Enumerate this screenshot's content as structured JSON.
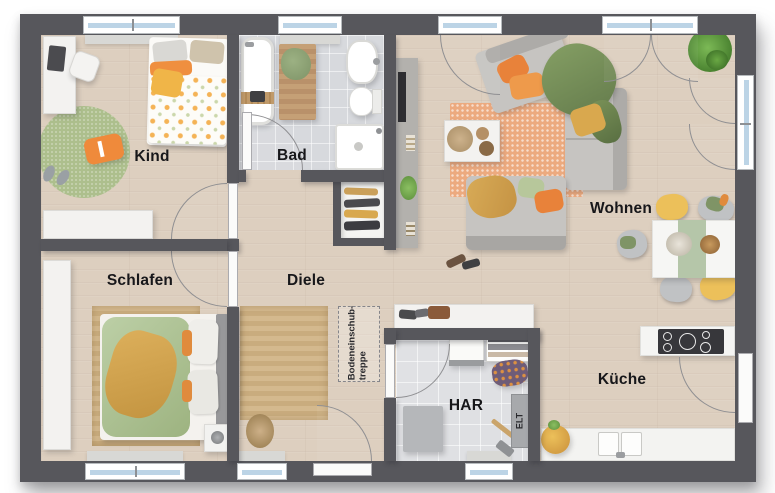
{
  "rooms": [
    {
      "id": "kind",
      "label": "Kind",
      "furniture": [
        "desk",
        "desk-chair",
        "single-bed",
        "round-rug",
        "floor-pillow",
        "slippers",
        "sideboard"
      ]
    },
    {
      "id": "bad",
      "label": "Bad",
      "furniture": [
        "bathtub",
        "bath-mat",
        "washbasin",
        "toilet",
        "shower"
      ]
    },
    {
      "id": "wohnen",
      "label": "Wohnen",
      "furniture": [
        "tv-unit",
        "sofa",
        "lounge-sofa",
        "rug",
        "coffee-table",
        "dining-table",
        "dining-chairs",
        "corner-plant"
      ]
    },
    {
      "id": "schlafen",
      "label": "Schlafen",
      "furniture": [
        "wardrobe",
        "double-bed",
        "rug",
        "speaker"
      ]
    },
    {
      "id": "diele",
      "label": "Diele",
      "furniture": [
        "runner-rug",
        "shoe-cabinet",
        "sideboard",
        "dried-plant"
      ]
    },
    {
      "id": "har",
      "label": "HAR",
      "furniture": [
        "washing-machine",
        "drying-rack",
        "laundry-basket",
        "storage-box",
        "broom"
      ]
    },
    {
      "id": "kueche",
      "label": "Küche",
      "furniture": [
        "kitchen-peninsula",
        "cooktop",
        "counter",
        "double-sink",
        "fruit-basket"
      ]
    }
  ],
  "annotations": {
    "attic_hatch_line1": "Bodeneinschub-",
    "attic_hatch_line2": "treppe",
    "electrical_panel": "ELT"
  },
  "colors": {
    "wall": "#57575c",
    "wood_floor": "#ddcfbf",
    "tile_floor": "#d7d9dd",
    "accent_orange": "#e8873a",
    "accent_green": "#8ba06f",
    "accent_yellow": "#d9a84e",
    "window_glass": "#bcd4e6"
  }
}
